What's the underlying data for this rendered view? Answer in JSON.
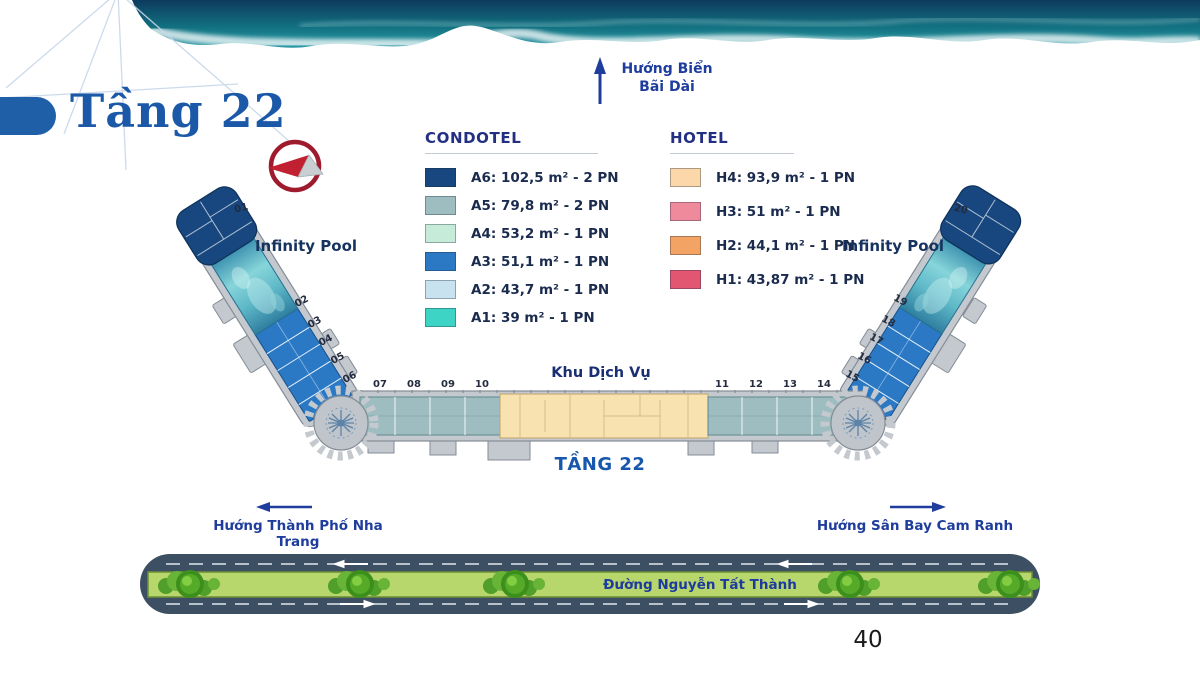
{
  "title": "Tầng 22",
  "page_number": "40",
  "sea_direction": {
    "line1": "Hướng Biển",
    "line2": "Bãi Dài"
  },
  "legend": {
    "condotel": {
      "header": "CONDOTEL",
      "items": [
        {
          "label": "A6: 102,5 m² - 2 PN",
          "color": "#17477E"
        },
        {
          "label": "A5: 79,8 m² - 2 PN",
          "color": "#9EBDC0"
        },
        {
          "label": "A4: 53,2 m² - 1 PN",
          "color": "#C6EBD8"
        },
        {
          "label": "A3: 51,1 m² - 1 PN",
          "color": "#2B79C4"
        },
        {
          "label": "A2: 43,7 m² - 1 PN",
          "color": "#C9E2EF"
        },
        {
          "label": "A1: 39 m² - 1 PN",
          "color": "#3DD3C5"
        }
      ]
    },
    "hotel": {
      "header": "HOTEL",
      "items": [
        {
          "label": "H4: 93,9 m² - 1 PN",
          "color": "#FBD7A9"
        },
        {
          "label": "H3: 51 m² - 1 PN",
          "color": "#EF8A9C"
        },
        {
          "label": "H2: 44,1 m² - 1 PN",
          "color": "#F3A364"
        },
        {
          "label": "H1: 43,87 m² - 1 PN",
          "color": "#E25672"
        }
      ]
    }
  },
  "plan": {
    "floor_label": "TẦNG 22",
    "service_area_label": "Khu Dịch Vụ",
    "pool_label_left": "Infinity Pool",
    "pool_label_right": "Infinity Pool",
    "unit_numbers": [
      "01",
      "02",
      "03",
      "04",
      "05",
      "06",
      "07",
      "08",
      "09",
      "10",
      "11",
      "12",
      "13",
      "14",
      "15",
      "16",
      "17",
      "18",
      "19",
      "20"
    ]
  },
  "directions": {
    "city": "Hướng Thành Phố Nha Trang",
    "airport": "Hướng Sân Bay Cam Ranh"
  },
  "road": {
    "name": "Đường Nguyễn Tất Thành"
  },
  "colors": {
    "accent_blue": "#1B59A8",
    "direction_text_blue": "#1F3D9C",
    "road_asphalt": "#3D4F63",
    "road_median_green": "#B7D66C",
    "service_area_fill": "#F8E2B0"
  }
}
